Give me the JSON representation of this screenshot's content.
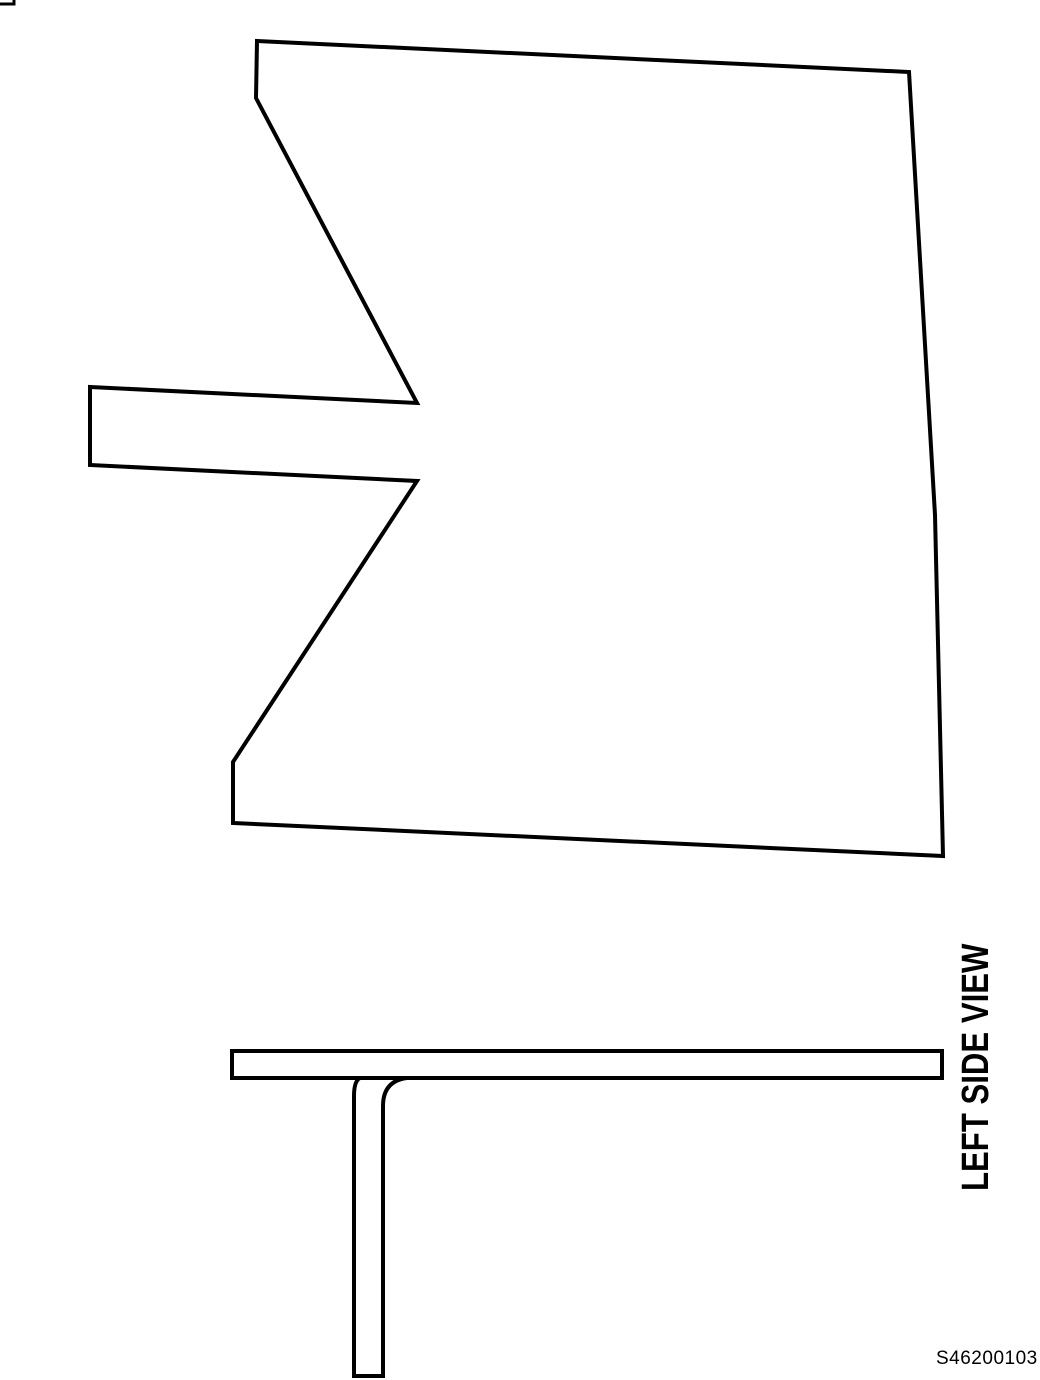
{
  "page": {
    "background": "#ffffff",
    "line_color": "#000000"
  },
  "figure": {
    "view_label": "LEFT SIDE VIEW",
    "figure_code": "S46200103"
  }
}
